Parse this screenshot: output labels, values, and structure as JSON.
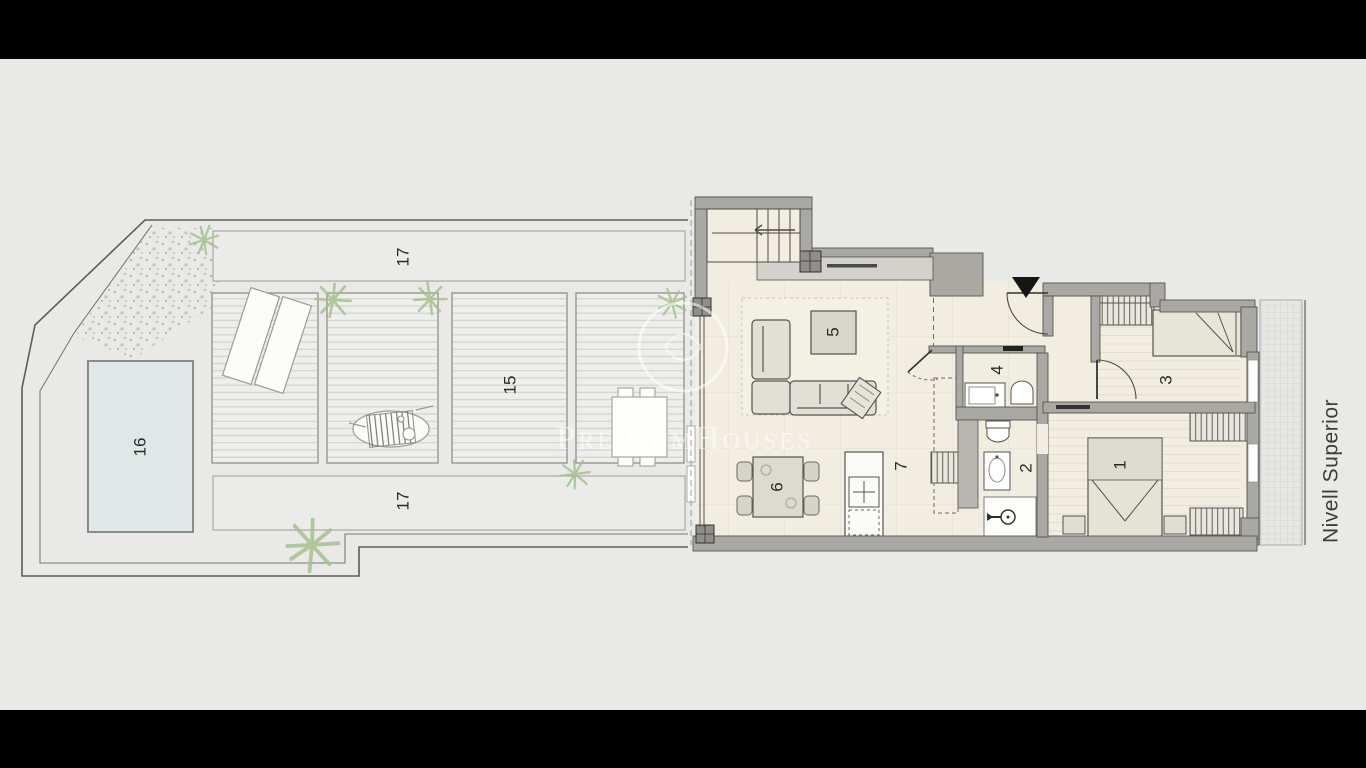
{
  "plan": {
    "level_label": "Nivell Superior",
    "watermark_brand": "PremiumHouses",
    "room_labels": {
      "bedroom_main": "1",
      "bathroom": "2",
      "bedroom_second": "3",
      "toilet": "4",
      "living_room": "5",
      "dining_area": "6",
      "kitchen": "7",
      "wood_deck": "15",
      "pool": "16",
      "terrace_upper_strip": "17",
      "terrace_lower_strip": "17"
    },
    "colors": {
      "background": "#e9e9e7",
      "letterbox": "#000000",
      "floor": "#f1ede0",
      "wall": "#a9a8a2",
      "pool_water": "#dfe8e7",
      "deck": "#eeeeec",
      "entrance_marker": "#151515",
      "label_text": "#2a2a28",
      "plant": "#a4c18c"
    }
  }
}
